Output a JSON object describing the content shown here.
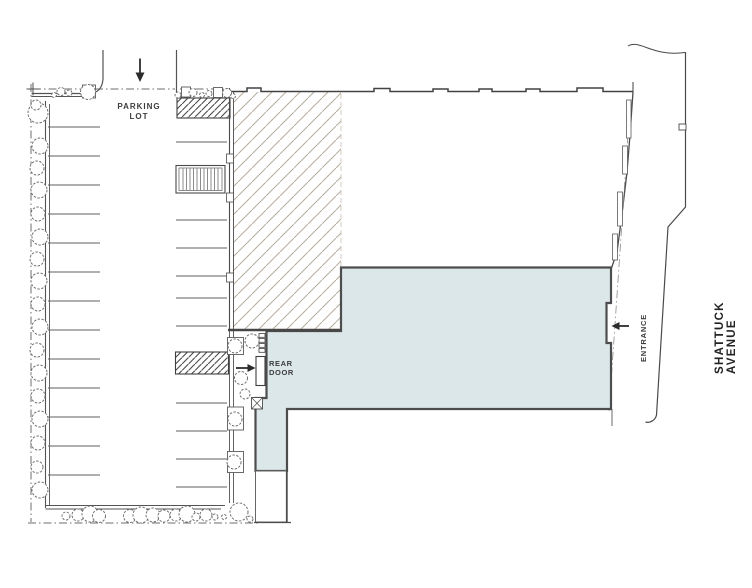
{
  "plan": {
    "labels": {
      "parking_line1": "PARKING",
      "parking_line2": "LOT",
      "rear_door_line1": "REAR",
      "rear_door_line2": "DOOR",
      "entrance": "ENTRANCE",
      "street": "SHATTUCK AVENUE"
    },
    "colors": {
      "highlight_fill": "#dce7e9",
      "ink": "#474747",
      "hatch_light": "#b7ada0",
      "hatch_dark": "#4a4a4a",
      "paper": "#ffffff"
    }
  }
}
